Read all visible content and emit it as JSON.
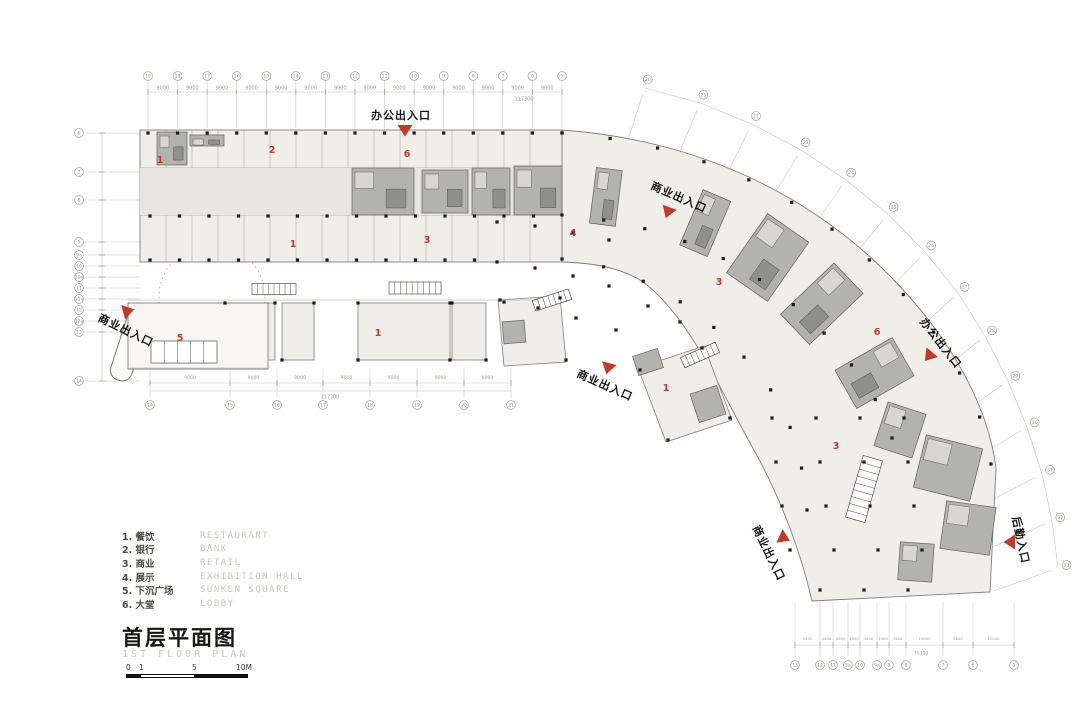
{
  "colors": {
    "red": "#c0392b",
    "building_fill": "#f0eee8",
    "court_fill": "#f7f6f2",
    "core_fill": "#b2b2ae",
    "core_band": "#e8e6df",
    "outline": "#7f7f7a",
    "partition": "#a5a5a0",
    "grid": "#c2c2bd",
    "bubble_stroke": "#9c9c97",
    "dim_text": "#9d9d98",
    "column_dot": "#1c1c1b"
  },
  "title": {
    "cn": "首层平面图",
    "en": "1ST FLOOR PLAN"
  },
  "legend": {
    "items": [
      {
        "num": "1.",
        "cn": "餐饮",
        "en": "RESTAURANT"
      },
      {
        "num": "2.",
        "cn": "银行",
        "en": "BANK"
      },
      {
        "num": "3.",
        "cn": "商业",
        "en": "RETAIL"
      },
      {
        "num": "4.",
        "cn": "展示",
        "en": "EXHIBITION HALL"
      },
      {
        "num": "5.",
        "cn": "下沉广场",
        "en": "SUNKEN SQUARE"
      },
      {
        "num": "6.",
        "cn": "大堂",
        "en": "LOBBY"
      }
    ]
  },
  "scalebar": {
    "labels": [
      "0",
      "1",
      "5",
      "10M"
    ]
  },
  "entrances": [
    {
      "id": "office-top",
      "text": "办公出入口",
      "x": 401,
      "y": 115,
      "rot": 0,
      "tri": {
        "x": 405,
        "y": 130,
        "rot": 0
      }
    },
    {
      "id": "retail-top-arc",
      "text": "商业出入口",
      "x": 679,
      "y": 197,
      "rot": 24,
      "tri": {
        "x": 668,
        "y": 212,
        "rot": 20
      }
    },
    {
      "id": "retail-left",
      "text": "商业出入口",
      "x": 126,
      "y": 330,
      "rot": 26,
      "tri": {
        "x": 128,
        "y": 311,
        "rot": -105
      }
    },
    {
      "id": "retail-mid",
      "text": "商业出入口",
      "x": 605,
      "y": 385,
      "rot": 24,
      "tri": {
        "x": 608,
        "y": 368,
        "rot": 15
      }
    },
    {
      "id": "office-right",
      "text": "办公出入口",
      "x": 941,
      "y": 343,
      "rot": 52,
      "tri": {
        "x": 929,
        "y": 356,
        "rot": 40
      }
    },
    {
      "id": "retail-bottom",
      "text": "商业出入口",
      "x": 769,
      "y": 553,
      "rot": 64,
      "tri": {
        "x": 784,
        "y": 538,
        "rot": -65
      }
    },
    {
      "id": "service-right",
      "text": "后勤入口",
      "x": 1021,
      "y": 540,
      "rot": 78,
      "tri": {
        "x": 1010,
        "y": 542,
        "rot": 90
      }
    }
  ],
  "area_labels": [
    {
      "n": "1",
      "x": 160,
      "y": 163
    },
    {
      "n": "2",
      "x": 272,
      "y": 153
    },
    {
      "n": "6",
      "x": 407,
      "y": 157
    },
    {
      "n": "1",
      "x": 293,
      "y": 247
    },
    {
      "n": "3",
      "x": 427,
      "y": 243
    },
    {
      "n": "4",
      "x": 573,
      "y": 236
    },
    {
      "n": "5",
      "x": 180,
      "y": 341
    },
    {
      "n": "1",
      "x": 378,
      "y": 336
    },
    {
      "n": "3",
      "x": 719,
      "y": 285
    },
    {
      "n": "1",
      "x": 666,
      "y": 391
    },
    {
      "n": "6",
      "x": 877,
      "y": 335
    },
    {
      "n": "3",
      "x": 836,
      "y": 449
    }
  ],
  "dimensions": {
    "top_total": "117300",
    "top_seg": "9000",
    "bottom_left_total": "117300",
    "bottom_left_seg": "9000",
    "bottom_right_total": "75300",
    "bottom_right_segs": [
      "3400",
      "4500",
      "4500",
      "4500",
      "3400",
      "5400",
      "3400",
      "13000",
      "3600",
      "12000"
    ]
  },
  "grid": {
    "top_labels": [
      "19",
      "18",
      "17",
      "16",
      "15",
      "14",
      "13",
      "12",
      "11",
      "10",
      "9",
      "8",
      "7",
      "6",
      "5"
    ],
    "left_labels": [
      "6",
      "7",
      "8",
      "9",
      "9a",
      "10",
      "10a",
      "11",
      "11a",
      "12",
      "12a",
      "13",
      "14"
    ],
    "bottom_left_labels": [
      "14",
      "15",
      "16",
      "17",
      "18",
      "19",
      "20",
      "21"
    ],
    "bottom_right_labels": [
      "13",
      "12",
      "11",
      "5a",
      "10",
      "9a",
      "9",
      "8",
      "7",
      "6",
      "5"
    ],
    "arc_labels": [
      "20",
      "21",
      "22",
      "23",
      "24",
      "25",
      "26",
      "27",
      "28",
      "29",
      "30",
      "31",
      "32",
      "33"
    ]
  }
}
